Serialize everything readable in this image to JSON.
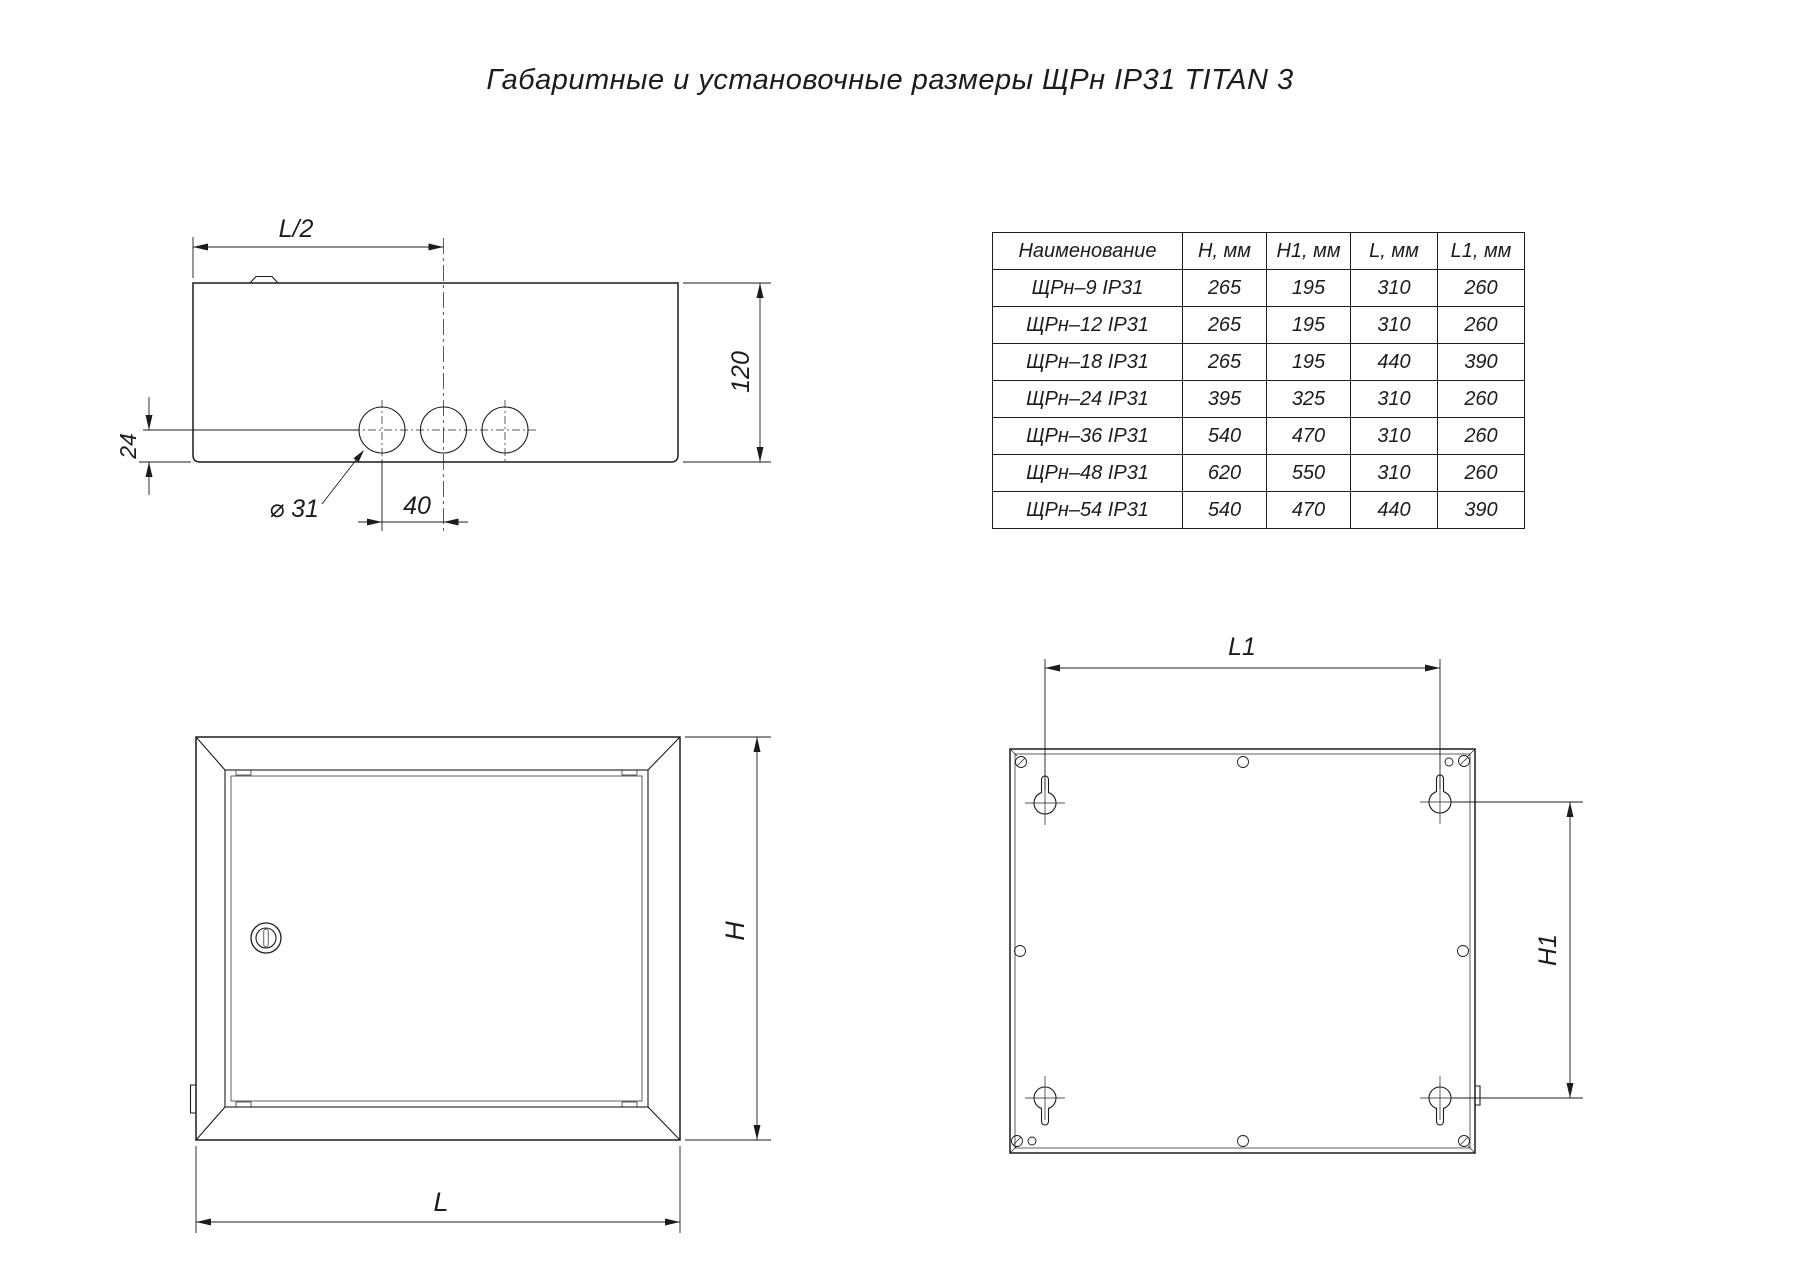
{
  "title": "Габаритные и установочные размеры ЩРн IP31 TITAN 3",
  "table": {
    "headers": [
      "Наименование",
      "H, мм",
      "H1, мм",
      "L, мм",
      "L1, мм"
    ],
    "rows": [
      [
        "ЩРн–9 IP31",
        "265",
        "195",
        "310",
        "260"
      ],
      [
        "ЩРн–12 IP31",
        "265",
        "195",
        "310",
        "260"
      ],
      [
        "ЩРн–18 IP31",
        "265",
        "195",
        "440",
        "390"
      ],
      [
        "ЩРн–24 IP31",
        "395",
        "325",
        "310",
        "260"
      ],
      [
        "ЩРн–36 IP31",
        "540",
        "470",
        "310",
        "260"
      ],
      [
        "ЩРн–48 IP31",
        "620",
        "550",
        "310",
        "260"
      ],
      [
        "ЩРн–54 IP31",
        "540",
        "470",
        "440",
        "390"
      ]
    ]
  },
  "labels": {
    "top_view": {
      "half_width": "L/2",
      "depth": "120",
      "hole_bottom_offset": "24",
      "hole_diameter": "⌀ 31",
      "hole_spacing": "40"
    },
    "front_view": {
      "height": "H",
      "width": "L"
    },
    "back_view": {
      "mount_width": "L1",
      "mount_height": "H1"
    }
  },
  "colors": {
    "line": "#1c1c1c",
    "background": "#ffffff"
  }
}
